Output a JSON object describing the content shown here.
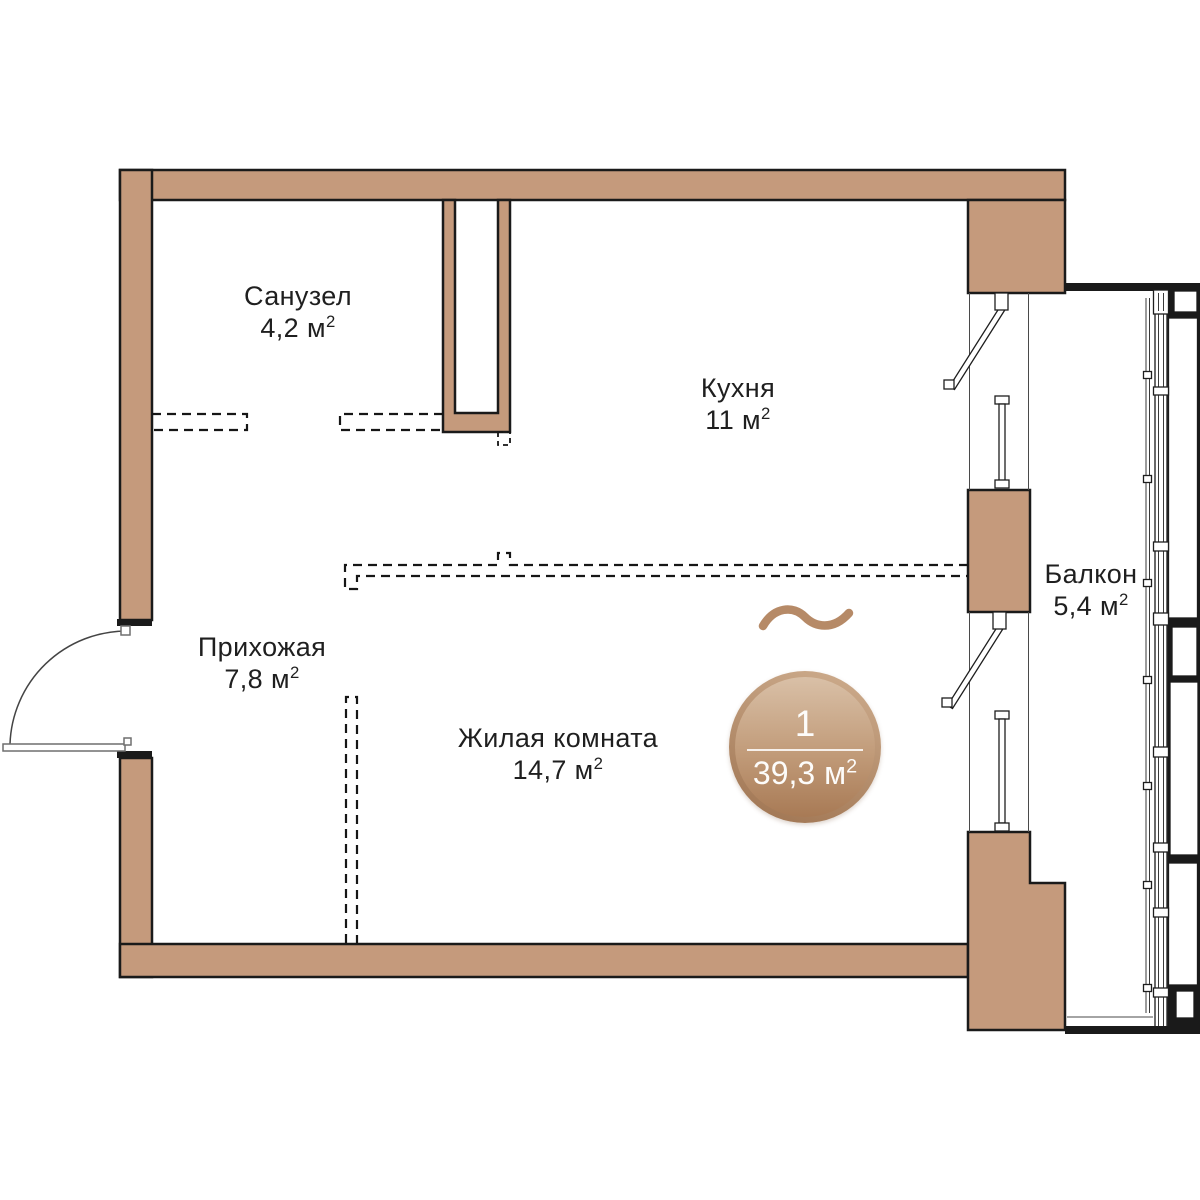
{
  "rooms": [
    {
      "name": "Санузел",
      "area": "4,2 м"
    },
    {
      "name": "Кухня",
      "area": "11 м"
    },
    {
      "name": "Прихожая",
      "area": "7,8 м"
    },
    {
      "name": "Жилая комната",
      "area": "14,7 м"
    },
    {
      "name": "Балкон",
      "area": "5,4 м"
    }
  ],
  "sup": "2",
  "badge": {
    "rooms_count": "1",
    "area": "39,3 м"
  },
  "colors": {
    "wall_fill": "#c59a7c",
    "wall_outline": "#1a1a1a",
    "badge_gradient_light": "#d9c0a7",
    "badge_gradient_dark": "#a87a55",
    "badge_rim": "#9e7350",
    "wave": "#b68a67",
    "label_text": "#1f1f1f"
  }
}
